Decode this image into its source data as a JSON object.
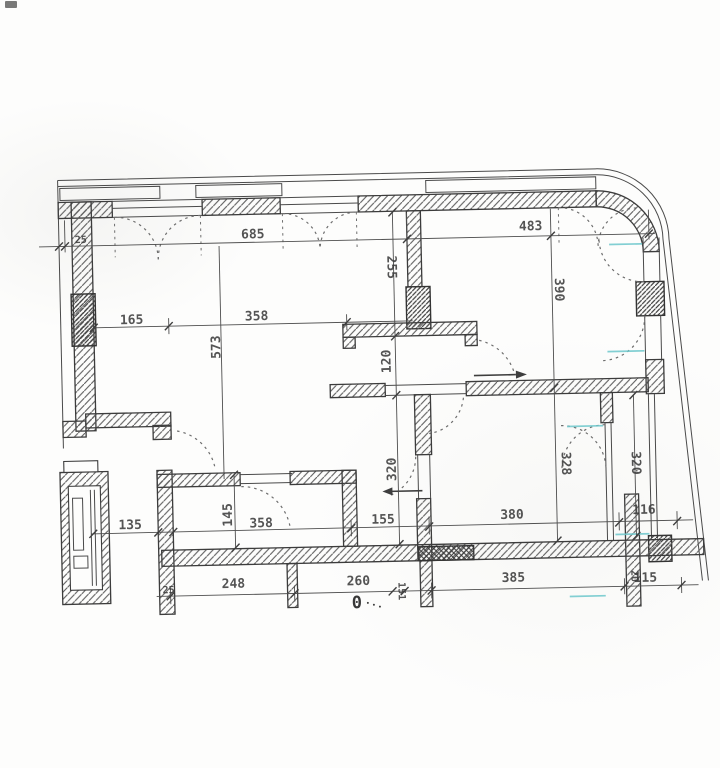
{
  "document": {
    "kind": "scanned architectural floor plan",
    "units": "centimeters",
    "origin_label": "0"
  },
  "colors": {
    "ink": "#3c3c3c",
    "hatch": "#585858",
    "accent_cyan": "#6cc7cb",
    "paper": "#fdfdfc"
  },
  "symbols": [
    "wall-hatch",
    "column-hatch",
    "window-casement-arc",
    "door-swing-arc",
    "dimension-tick",
    "origin-marker"
  ],
  "dimension_labels": [
    {
      "value": "25",
      "axis": "horizontal",
      "area": "top-left wall"
    },
    {
      "value": "685",
      "axis": "horizontal",
      "area": "top left room width"
    },
    {
      "value": "483",
      "axis": "horizontal",
      "area": "top right room width"
    },
    {
      "value": "165",
      "axis": "horizontal",
      "area": "left room"
    },
    {
      "value": "358",
      "axis": "horizontal",
      "area": "left room"
    },
    {
      "value": "573",
      "axis": "vertical",
      "area": "left room depth"
    },
    {
      "value": "255",
      "axis": "vertical",
      "area": "center partition"
    },
    {
      "value": "390",
      "axis": "vertical",
      "area": "right room depth"
    },
    {
      "value": "120",
      "axis": "vertical",
      "area": "center passage"
    },
    {
      "value": "320",
      "axis": "vertical",
      "area": "center corridor"
    },
    {
      "value": "328",
      "axis": "vertical",
      "area": "lower right room"
    },
    {
      "value": "320",
      "axis": "vertical",
      "area": "right balcony strip"
    },
    {
      "value": "145",
      "axis": "vertical",
      "area": "lower left room"
    },
    {
      "value": "135",
      "axis": "horizontal",
      "area": "lower row"
    },
    {
      "value": "358",
      "axis": "horizontal",
      "area": "lower row"
    },
    {
      "value": "155",
      "axis": "horizontal",
      "area": "lower row"
    },
    {
      "value": "380",
      "axis": "horizontal",
      "area": "lower row"
    },
    {
      "value": "116",
      "axis": "horizontal",
      "area": "lower row"
    },
    {
      "value": "248",
      "axis": "horizontal",
      "area": "bottom row"
    },
    {
      "value": "260",
      "axis": "horizontal",
      "area": "bottom row"
    },
    {
      "value": "151",
      "axis": "vertical",
      "area": "bottom row"
    },
    {
      "value": "385",
      "axis": "horizontal",
      "area": "bottom row"
    },
    {
      "value": "115",
      "axis": "horizontal",
      "area": "bottom row"
    },
    {
      "value": "25",
      "axis": "horizontal",
      "area": "bottom-left wall"
    },
    {
      "value": "0",
      "axis": "horizontal",
      "area": "origin marker"
    },
    {
      "value": "20",
      "axis": "vertical",
      "area": "bottom-right wall"
    }
  ]
}
